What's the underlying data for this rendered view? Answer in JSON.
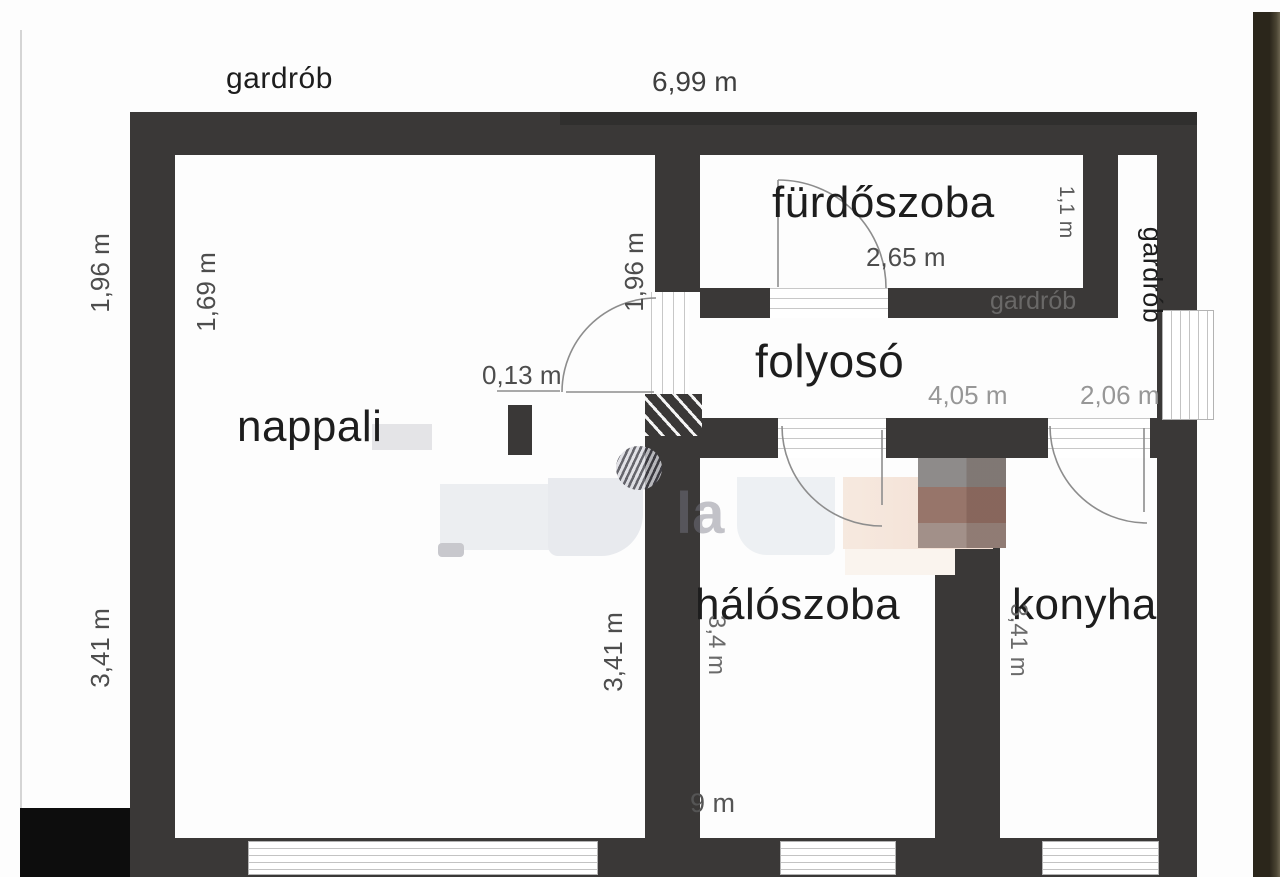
{
  "colors": {
    "wall": "#3a3837",
    "floor": "#ffffff",
    "black_block": "#0d0d0d",
    "right_side_strip": "#332c1f",
    "room_label_text": "#1d1d1d",
    "dimension_text": "#4d4d4d",
    "dimension_text_light": "#979797"
  },
  "labels": {
    "gardrob_top": "gardrób",
    "nappali": "nappali",
    "furdoszoba": "fürdőszoba",
    "folyoso": "folyosó",
    "haloszoba": "hálószoba",
    "konyha": "konyha",
    "gardrob_right": "gardrób"
  },
  "dims": {
    "top_width": "6,99 m",
    "outer_left_upper": "1,96 m",
    "outer_left_lower": "3,41 m",
    "nappali_left": "1,69 m",
    "nappali_right": "3,41 m",
    "nappali_door": "1,96 m",
    "pillar": "0,13 m",
    "furdoszoba_width": "2,65 m",
    "furdoszoba_depth": "1,1 m",
    "folyoso_width": "4,05 m",
    "folyoso_right_width": "2,06 m",
    "haloszoba_depth": "3,4 m",
    "haloszoba_bottom": "9 m",
    "konyha_depth": "3,41 m"
  },
  "watermark": {
    "logo_text": "la",
    "wall_text": "gardrób"
  }
}
